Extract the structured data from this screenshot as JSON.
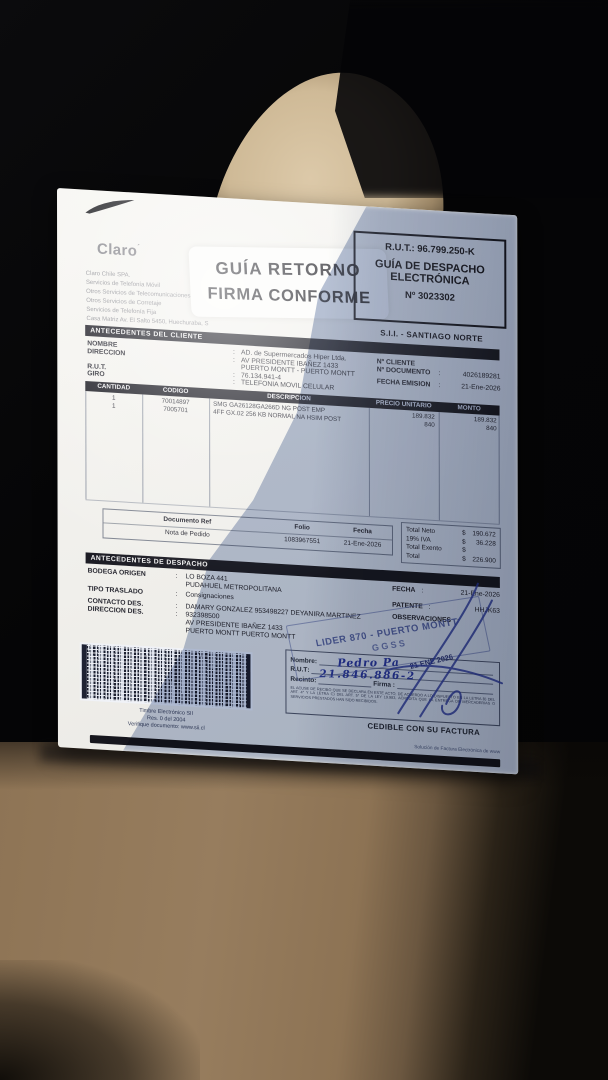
{
  "letterhead": {
    "brand": "Claro",
    "brand_mark": "´",
    "lines": [
      "Claro Chile SPA.",
      "Servicios de Telefonía Móvil",
      "Otros Servicios de Telecomunicaciones",
      "Otros Servicios de Corretaje",
      "Servicios de Telefonía Fija",
      "Casa Matriz Av. El Salto 5450, Huechuraba, S"
    ]
  },
  "return_sticker": {
    "line1": "GUÍA RETORNO",
    "line2": "FIRMA CONFORME"
  },
  "rut_box": {
    "rut": "R.U.T.: 96.799.250-K",
    "doc_type_line1": "GUÍA DE DESPACHO",
    "doc_type_line2": "ELECTRÓNICA",
    "number": "Nº 3023302"
  },
  "sii_office": "S.I.I. - SANTIAGO NORTE",
  "client": {
    "section_title": "ANTECEDENTES DEL CLIENTE",
    "rows": [
      {
        "label": "NOMBRE",
        "sep": ":",
        "value": "AD. de Supermercados Hiper Ltda."
      },
      {
        "label": "DIRECCION",
        "sep": ":",
        "value": "AV PRESIDENTE IBAÑEZ 1433"
      },
      {
        "label": "",
        "sep": "",
        "value": "PUERTO MONTT -  PUERTO MONTT"
      },
      {
        "label": "R.U.T.",
        "sep": ":",
        "value": "76.134.941-4"
      },
      {
        "label": "GIRO",
        "sep": ":",
        "value": "TELEFONIA MOVIL CELULAR"
      }
    ],
    "right_rows": [
      {
        "label": "Nº CLIENTE",
        "sep": "",
        "value": ""
      },
      {
        "label": "Nº DOCUMENTO",
        "sep": ":",
        "value": "4026189281"
      },
      {
        "label": "FECHA EMISION",
        "sep": ":",
        "value": "21-Ene-2026"
      }
    ]
  },
  "items": {
    "headers": [
      "CANTIDAD",
      "CODIGO",
      "DESCRIPCION",
      "PRECIO UNITARIO",
      "MONTO"
    ],
    "rows": [
      {
        "qty": "1",
        "code": "70014897",
        "desc": "SMG GA26128GA266D NG POST EMP",
        "unit": "189.832",
        "amount": "189.832"
      },
      {
        "qty": "1",
        "code": "7005701",
        "desc": "4FF GX.02 256 KB NORMAL NA HSIM POST",
        "unit": "840",
        "amount": "840"
      }
    ]
  },
  "reference": {
    "headers": [
      "Documento Ref",
      "Folio",
      "Fecha"
    ],
    "values": [
      "Nota de Pedido",
      "1083967551",
      "21-Ene-2026"
    ]
  },
  "totals": {
    "currency": "$",
    "rows": [
      {
        "label": "Total Neto",
        "value": "190.672"
      },
      {
        "label": "19% IVA",
        "value": "36.228"
      },
      {
        "label": "Total Exento",
        "value": ""
      },
      {
        "label": "Total",
        "value": "226.900"
      }
    ]
  },
  "dispatch": {
    "section_title": "ANTECEDENTES DE DESPACHO",
    "bodega_label": "BODEGA ORIGEN",
    "bodega_value": "LO BOZA 441",
    "bodega_value2": "PUDAHUEL  METROPOLITANA",
    "tipo_label": "TIPO TRASLADO",
    "tipo_value": "Consignaciones",
    "contacto_label": "CONTACTO DES.",
    "contacto_value": "DAMARY GONZALEZ 953498227 DEYANIRA MARTINEZ",
    "direccion_label": "DIRECCION DES.",
    "direccion_value": "932398500",
    "direccion_line2": "AV PRESIDENTE IBAÑEZ 1433",
    "direccion_line3": "PUERTO MONTT   PUERTO MONTT",
    "fecha_label": "FECHA",
    "fecha_value": "21-Ene-2026",
    "patente_label": "PATENTE",
    "patente_value": "HHJK63",
    "observaciones_label": "OBSERVACIONES"
  },
  "lider_stamp": {
    "line1": "LIDER 870 - PUERTO MONTT",
    "line2": "GGSS"
  },
  "reception": {
    "nombre_label": "Nombre",
    "rut_label": "R.U.T",
    "recinto_label": "Recinto",
    "firma_label": "Firma :",
    "fine_print": "EL ACUSE DE RECIBO QUE SE DECLARA EN ESTE ACTO, DE ACUERDO A LO DISPUESTO EN LA LETRA B) DEL ART. 4° Y LA LETRA C) DEL ART. 5° DE LA LEY 19.983, ACREDITA QUE LA ENTREGA DE MERCADERIAS O SERVICIOS PRESTADOS HAN SIDO RECIBIDOS.",
    "handwritten_name": "Pedro Pa",
    "handwritten_rut": "21.846.886-2",
    "date_stamp": "21 ENE 2026"
  },
  "seal": {
    "lines": [
      "Timbre Electrónico SII",
      "Res. 0 del 2004",
      "Verifique documento: www.sii.cl"
    ]
  },
  "cedible": "CEDIBLE CON SU FACTURA",
  "footer_note": "Solución de Factura Electrónica de www",
  "misc": {
    "colon": ":"
  }
}
